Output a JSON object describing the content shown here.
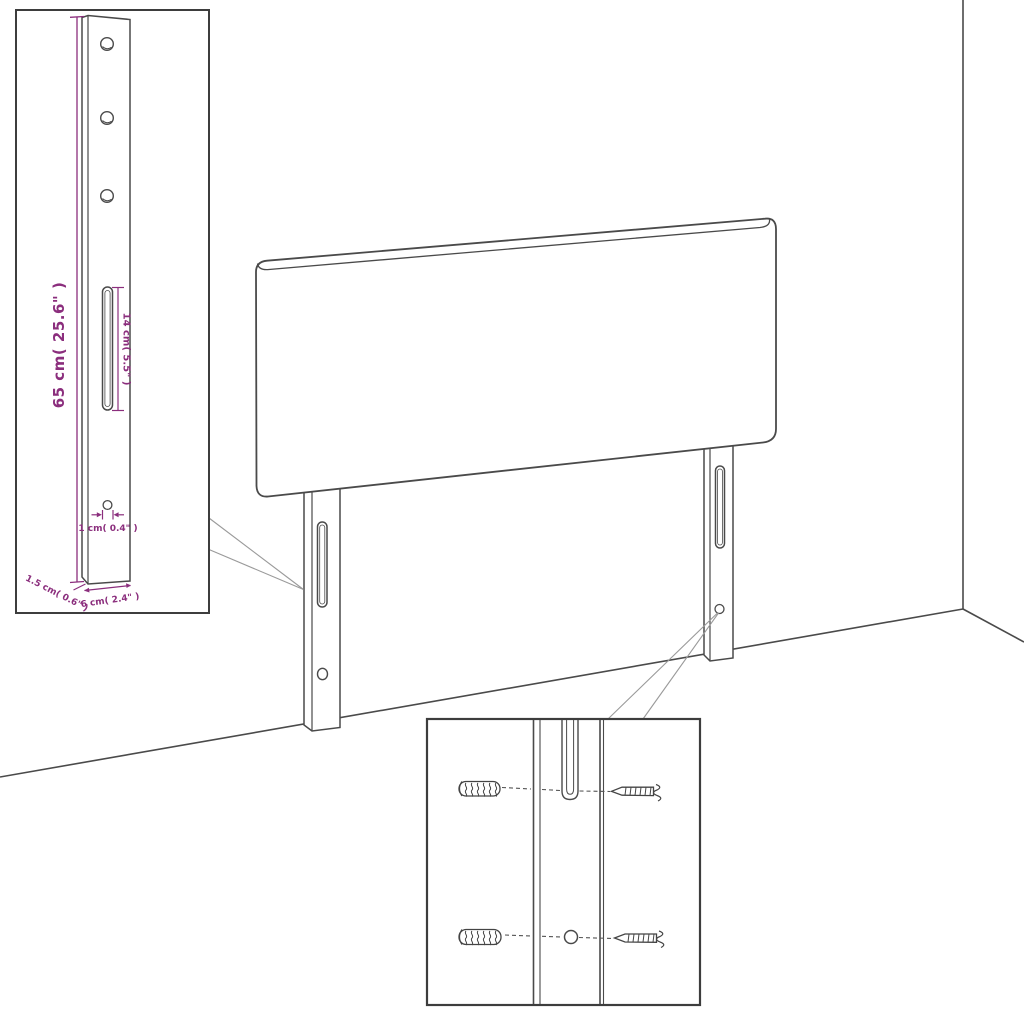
{
  "diagram": {
    "colors": {
      "background": "#ffffff",
      "line": "#4a4a4a",
      "inset_border": "#3d3d3d",
      "dimension": "#8b2e7d",
      "leader": "#9a9a9a"
    },
    "icons": [
      "headboard-panel",
      "mounting-leg",
      "wall-plug",
      "screw"
    ]
  },
  "leg_detail": {
    "height_label": "65 cm( 25.6\" )",
    "slot_label": "14 cm( 5.5\" )",
    "hole_label": "1 cm( 0.4\" )",
    "thickness_label": "1.5 cm( 0.6\" )",
    "width_label": "6 cm( 2.4\" )"
  }
}
